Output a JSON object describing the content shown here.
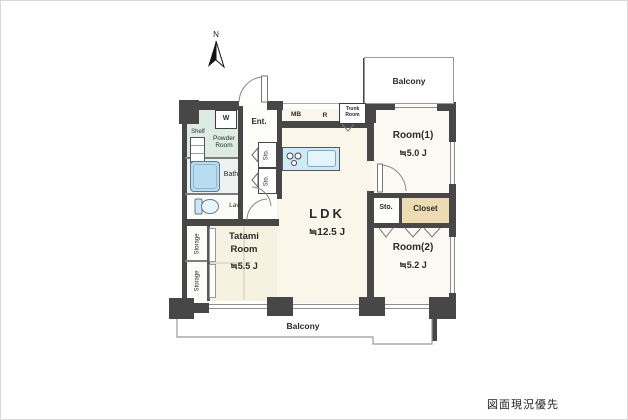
{
  "annotation": "図面現況優先",
  "compass": "N",
  "labels": {
    "ent": "Ent.",
    "washer": "W",
    "shelf": "Shelf",
    "powder_l1": "Powder",
    "powder_l2": "Room",
    "bath": "Bath",
    "lav": "Lav.",
    "mb": "MB",
    "r": "R",
    "trunk_l1": "Trunk",
    "trunk_l2": "Room",
    "sto_hall_upper": "Sto.",
    "sto_hall_lower": "Sto.",
    "storage_upper": "Storage",
    "storage_lower": "Storage",
    "sto_right": "Sto.",
    "closet": "Closet",
    "balcony_top": "Balcony",
    "balcony_bottom": "Balcony"
  },
  "rooms": {
    "ldk": {
      "name": "LDK",
      "size": "≒12.5 J"
    },
    "tatami": {
      "name_l1": "Tatami",
      "name_l2": "Room",
      "size": "≒5.5 J"
    },
    "room1": {
      "name": "Room(1)",
      "size": "≒5.0 J"
    },
    "room2": {
      "name": "Room(2)",
      "size": "≒5.2 J"
    }
  },
  "colors": {
    "wall": "#474747",
    "cream": "#faf6ea",
    "room": "#fbf9f2",
    "mint": "#dcece5",
    "bathroom": "#edf2f0",
    "tub": "#b9ddf0",
    "tatami": "#f6f2e2",
    "counter": "#cfe9f5",
    "beige": "#eddcb2"
  }
}
